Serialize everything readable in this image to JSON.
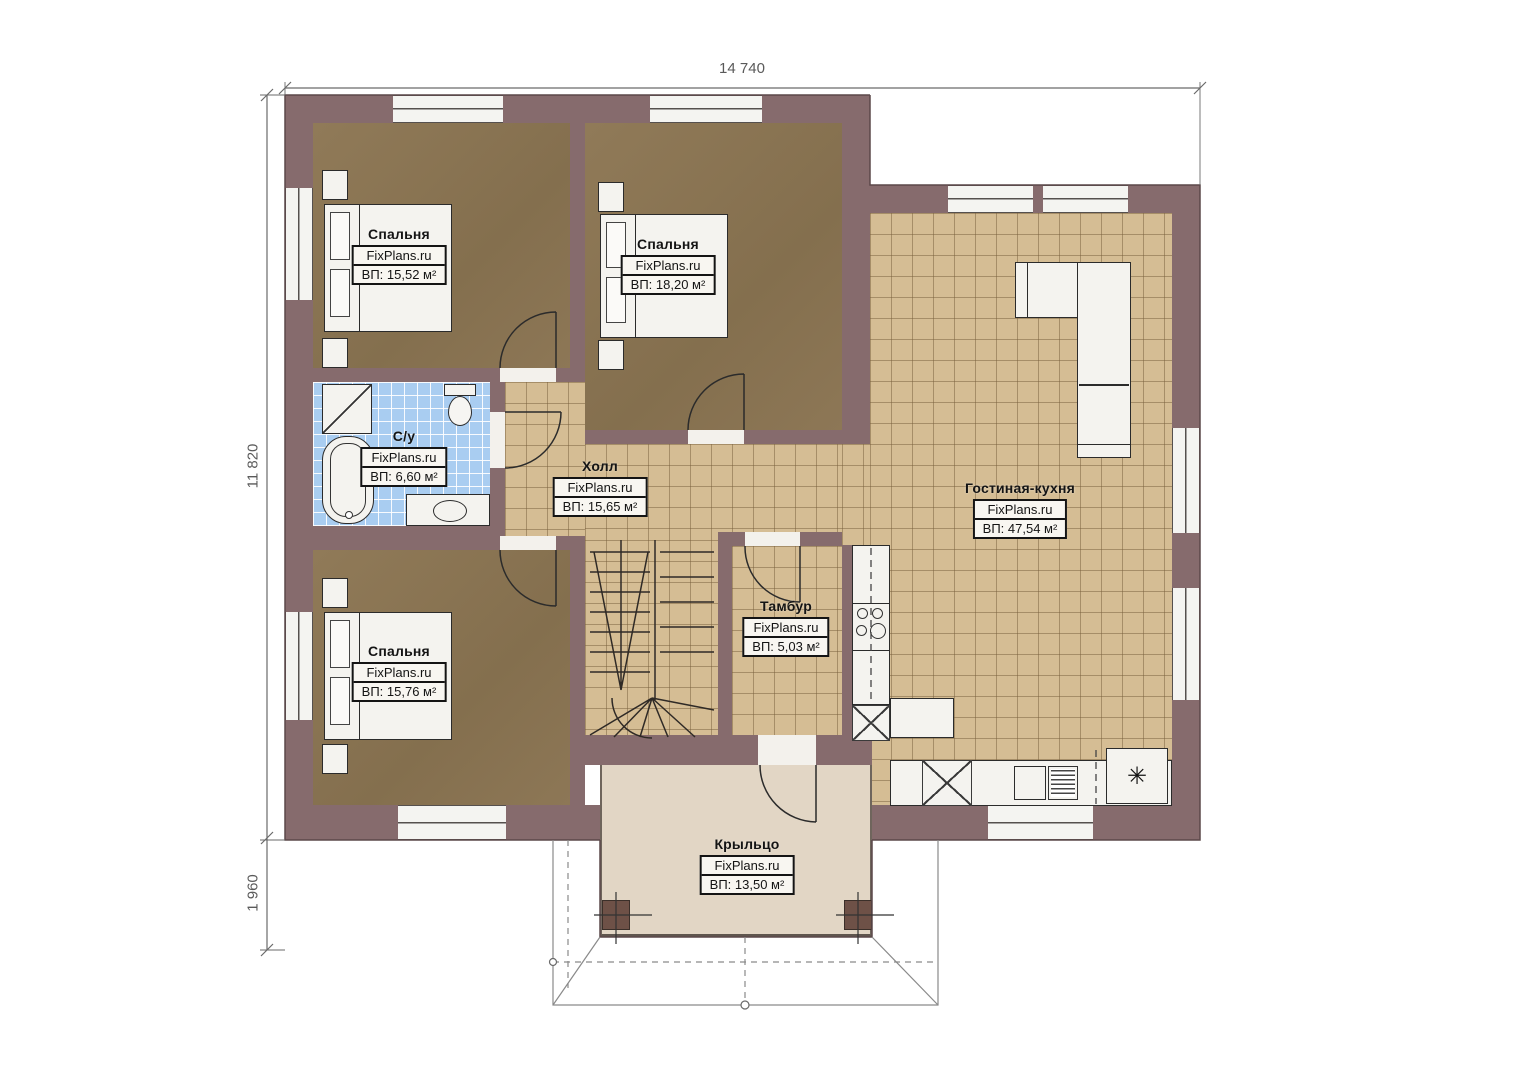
{
  "plan": {
    "watermark": "FixPlans.ru",
    "dimensions": {
      "width": "14 740",
      "height": "11 820",
      "porch_depth": "1 960"
    },
    "rooms": {
      "bedroom1": {
        "name": "Спальня",
        "area": "ВП: 15,52 м²"
      },
      "bedroom2": {
        "name": "Спальня",
        "area": "ВП: 18,20 м²"
      },
      "bathroom": {
        "name": "С/у",
        "area": "ВП: 6,60 м²"
      },
      "hall": {
        "name": "Холл",
        "area": "ВП: 15,65 м²"
      },
      "bedroom3": {
        "name": "Спальня",
        "area": "ВП: 15,76 м²"
      },
      "tambour": {
        "name": "Тамбур",
        "area": "ВП: 5,03 м²"
      },
      "living_kitchen": {
        "name": "Гостиная-кухня",
        "area": "ВП: 47,54 м²"
      },
      "porch": {
        "name": "Крыльцо",
        "area": "ВП: 13,50 м²"
      }
    },
    "icons": {
      "boiler": "✳"
    },
    "colors": {
      "wall": "#866b6d",
      "bedroom_floor": "#8d7756",
      "tile_floor": "#d5bd94",
      "bath_tile": "#a9cdf1",
      "porch_floor": "#e2d6c5"
    }
  }
}
